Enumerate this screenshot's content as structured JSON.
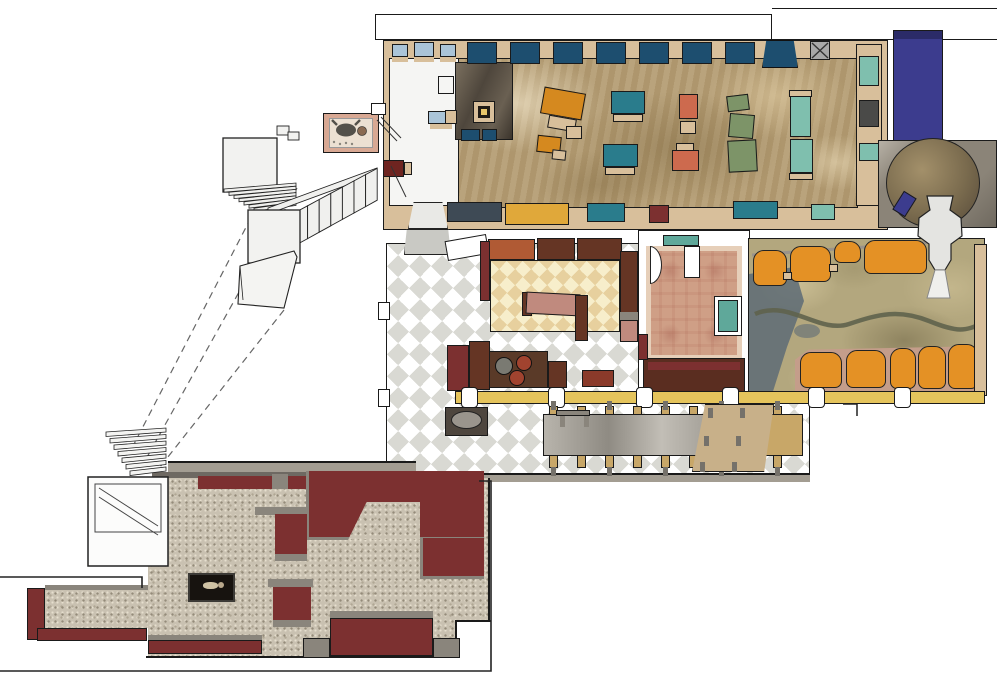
{
  "scene": {
    "description": "architectural floor plan, axonometric rendering, no text labels",
    "background": "#ffffff"
  },
  "colors": {
    "outline": "#1a1a1a",
    "wall_tan": "#d8bf9b",
    "sidewalk_gray": "#a39d92",
    "hall_marble": "#b49c72",
    "dark_wood": "#54483a",
    "booth_navy": "#1d4e6f",
    "bench_lightblue": "#aac4d8",
    "table_teal": "#2a7c8c",
    "table_mint": "#7fbfae",
    "table_green": "#7d9468",
    "table_salmon": "#cd6a4e",
    "table_orange": "#d5891f",
    "bench_yellow": "#e0a83a",
    "bench_slate": "#3e4a55",
    "maroon": "#7c3030",
    "stage_indigo": "#3c3c8e",
    "counter_yellow": "#e5c45c",
    "checker_gray": "#d9d9d3",
    "cream_light": "#f7eecb",
    "cream_dark": "#e7d09e",
    "banquette_rust": "#b05a34",
    "banquette_brown": "#653524",
    "seat_pink": "#c08a7e",
    "cook_counter": "#5a3a28",
    "burner_gray": "#7a7a72",
    "burner_red": "#a1432f",
    "gray_marble": "#b0aca4",
    "booth_orange": "#e49125",
    "lounge_base": "#b3a77e",
    "river_green": "#5f634c",
    "water_slate": "#5d6b76",
    "platform_pink": "#c49d8a",
    "rug_base": "#cf9f86",
    "rug_teal": "#5fa89a",
    "banquette_dark": "#5a2d20",
    "granite_base": "#c9c1b1",
    "wall_gray": "#8a857c",
    "jamb_dark": "#6e6962",
    "display_dark": "#17130f",
    "figure_beige": "#cfc2a4",
    "stair_white": "#f0f0ee",
    "wood_bench": "#c8a768",
    "ramp_tan": "#c8b089",
    "circle_brown": "#7a6b4e",
    "surround_gray": "#8b8478"
  }
}
